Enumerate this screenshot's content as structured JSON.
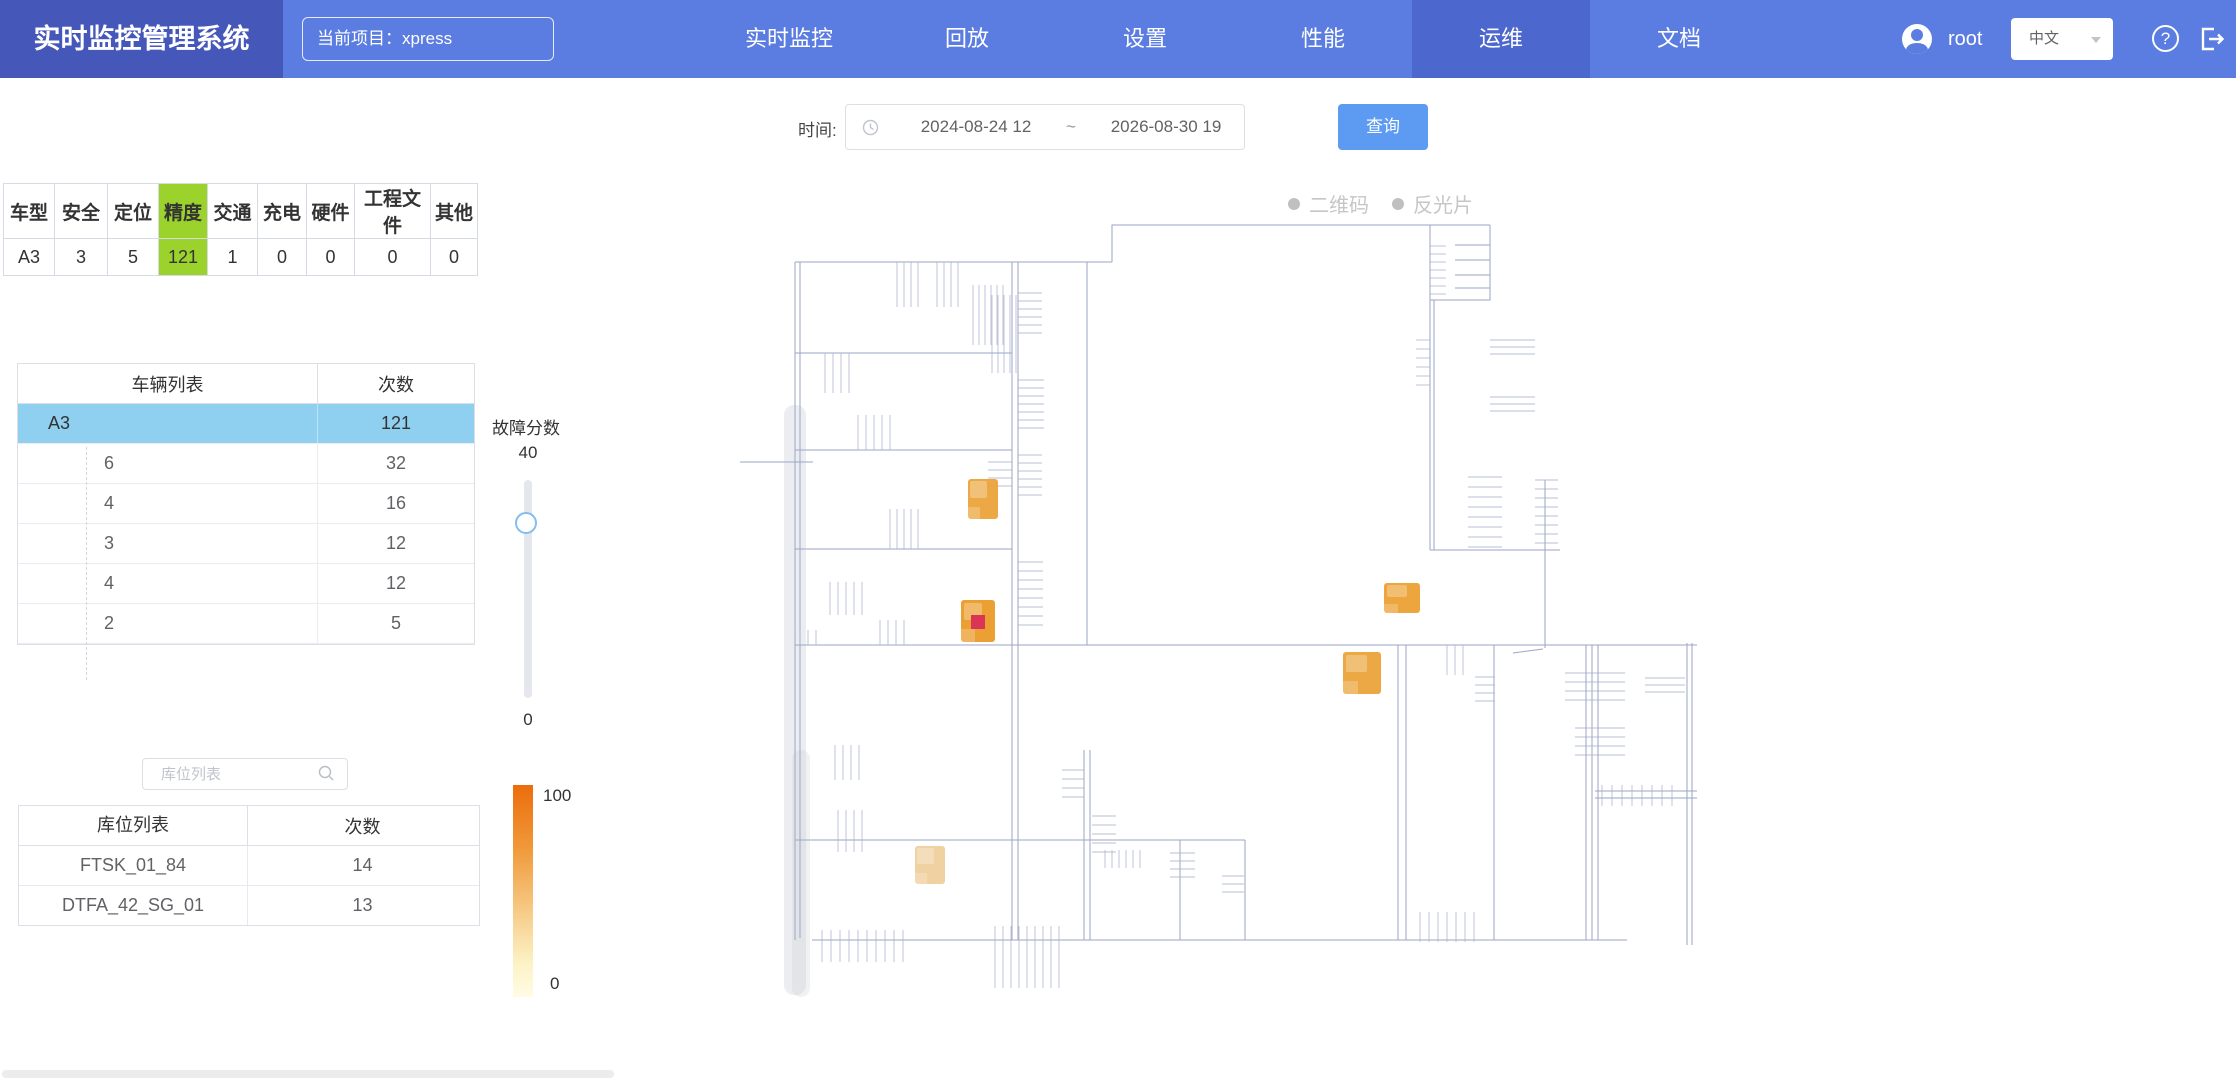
{
  "header": {
    "app_title": "实时监控管理系统",
    "project_label": "当前项目：xpress",
    "nav": [
      {
        "label": "实时监控"
      },
      {
        "label": "回放"
      },
      {
        "label": "设置"
      },
      {
        "label": "性能"
      },
      {
        "label": "运维"
      },
      {
        "label": "文档"
      }
    ],
    "username": "root",
    "language": "中文",
    "help_glyph": "?"
  },
  "toolbar": {
    "time_label": "时间:",
    "time_start": "2024-08-24 12",
    "time_separator": "~",
    "time_end": "2026-08-30 19",
    "query_button": "查询"
  },
  "category_table": {
    "headers": [
      "车型",
      "安全",
      "定位",
      "精度",
      "交通",
      "充电",
      "硬件",
      "工程文件",
      "其他"
    ],
    "values": [
      "A3",
      "3",
      "5",
      "121",
      "1",
      "0",
      "0",
      "0",
      "0"
    ],
    "highlight_column": "精度",
    "highlight_color": "#9bd32c"
  },
  "vehicle_table": {
    "col1_header": "车辆列表",
    "col2_header": "次数",
    "selected_row": {
      "name": "A3",
      "count": "121"
    },
    "selected_bg": "#8fd0f0",
    "rows": [
      {
        "name": "6",
        "count": "32"
      },
      {
        "name": "4",
        "count": "16"
      },
      {
        "name": "3",
        "count": "12"
      },
      {
        "name": "4",
        "count": "12"
      },
      {
        "name": "2",
        "count": "5"
      }
    ]
  },
  "fault_slider": {
    "label": "故障分数",
    "top_value": "40",
    "bottom_value": "0"
  },
  "storage": {
    "search_placeholder": "库位列表",
    "col1_header": "库位列表",
    "col2_header": "次数",
    "rows": [
      {
        "name": "FTSK_01_84",
        "count": "14"
      },
      {
        "name": "DTFA_42_SG_01",
        "count": "13"
      }
    ]
  },
  "gradient_legend": {
    "top_label": "100",
    "bottom_label": "0",
    "top_color": "#ec6c0c",
    "bottom_color": "#fffce4"
  },
  "map": {
    "legend": [
      {
        "label": "二维码"
      },
      {
        "label": "反光片"
      }
    ],
    "heat_spots": [
      {
        "left": 228,
        "top": 279,
        "w": 30,
        "h": 40,
        "color": "#eca43c"
      },
      {
        "left": 644,
        "top": 383,
        "w": 36,
        "h": 30,
        "color": "#eda233"
      },
      {
        "left": 221,
        "top": 400,
        "w": 34,
        "h": 42,
        "color": "#ec9a28",
        "red_center": true,
        "red_color": "#d92a4e"
      },
      {
        "left": 603,
        "top": 452,
        "w": 38,
        "h": 42,
        "color": "#eca43a"
      },
      {
        "left": 175,
        "top": 646,
        "w": 30,
        "h": 38,
        "color": "#f0cf9c"
      }
    ]
  }
}
